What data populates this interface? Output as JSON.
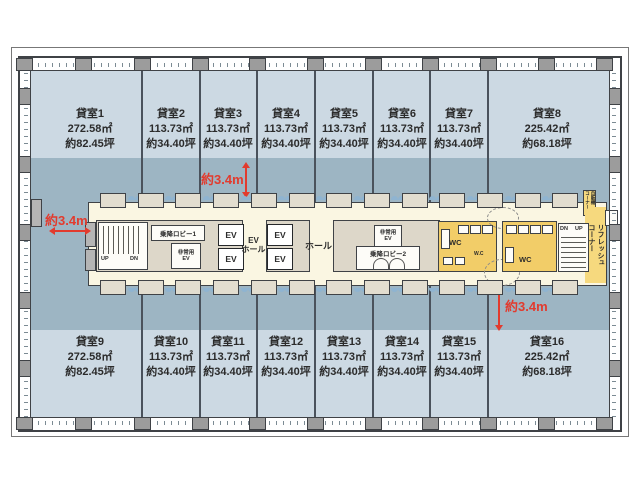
{
  "rooms": {
    "top": [
      {
        "name": "貸室1",
        "area": "272.58㎡",
        "tsubo": "約82.45坪"
      },
      {
        "name": "貸室2",
        "area": "113.73㎡",
        "tsubo": "約34.40坪"
      },
      {
        "name": "貸室3",
        "area": "113.73㎡",
        "tsubo": "約34.40坪"
      },
      {
        "name": "貸室4",
        "area": "113.73㎡",
        "tsubo": "約34.40坪"
      },
      {
        "name": "貸室5",
        "area": "113.73㎡",
        "tsubo": "約34.40坪"
      },
      {
        "name": "貸室6",
        "area": "113.73㎡",
        "tsubo": "約34.40坪"
      },
      {
        "name": "貸室7",
        "area": "113.73㎡",
        "tsubo": "約34.40坪"
      },
      {
        "name": "貸室8",
        "area": "225.42㎡",
        "tsubo": "約68.18坪"
      }
    ],
    "bottom": [
      {
        "name": "貸室9",
        "area": "272.58㎡",
        "tsubo": "約82.45坪"
      },
      {
        "name": "貸室10",
        "area": "113.73㎡",
        "tsubo": "約34.40坪"
      },
      {
        "name": "貸室11",
        "area": "113.73㎡",
        "tsubo": "約34.40坪"
      },
      {
        "name": "貸室12",
        "area": "113.73㎡",
        "tsubo": "約34.40坪"
      },
      {
        "name": "貸室13",
        "area": "113.73㎡",
        "tsubo": "約34.40坪"
      },
      {
        "name": "貸室14",
        "area": "113.73㎡",
        "tsubo": "約34.40坪"
      },
      {
        "name": "貸室15",
        "area": "113.73㎡",
        "tsubo": "約34.40坪"
      },
      {
        "name": "貸室16",
        "area": "225.42㎡",
        "tsubo": "約68.18坪"
      }
    ]
  },
  "dimensions": {
    "top": "約3.4m",
    "left": "約3.4m",
    "bottom": "約3.4m"
  },
  "core": {
    "lobby1": "乗降ロビー1",
    "lobby2": "乗降ロビー2",
    "emergency_ev": "非常用\nEV",
    "ev": "EV",
    "ev_hall": "EV\nホール",
    "hall": "ホール",
    "wc": "WC",
    "wc_small": "W.C",
    "up": "UP",
    "dn": "DN",
    "refresh_corner": "リフレッシュ\nコーナー",
    "vending_corner": "自販機\nコーナー"
  },
  "colors": {
    "room_fill": "#ccd9e3",
    "core_band": "#9db5c3",
    "corridor": "#faf6e2",
    "highlight_yellow": "#f2cd68",
    "refresh_yellow": "#f6d97e",
    "dimension_red": "#e23b2e"
  }
}
